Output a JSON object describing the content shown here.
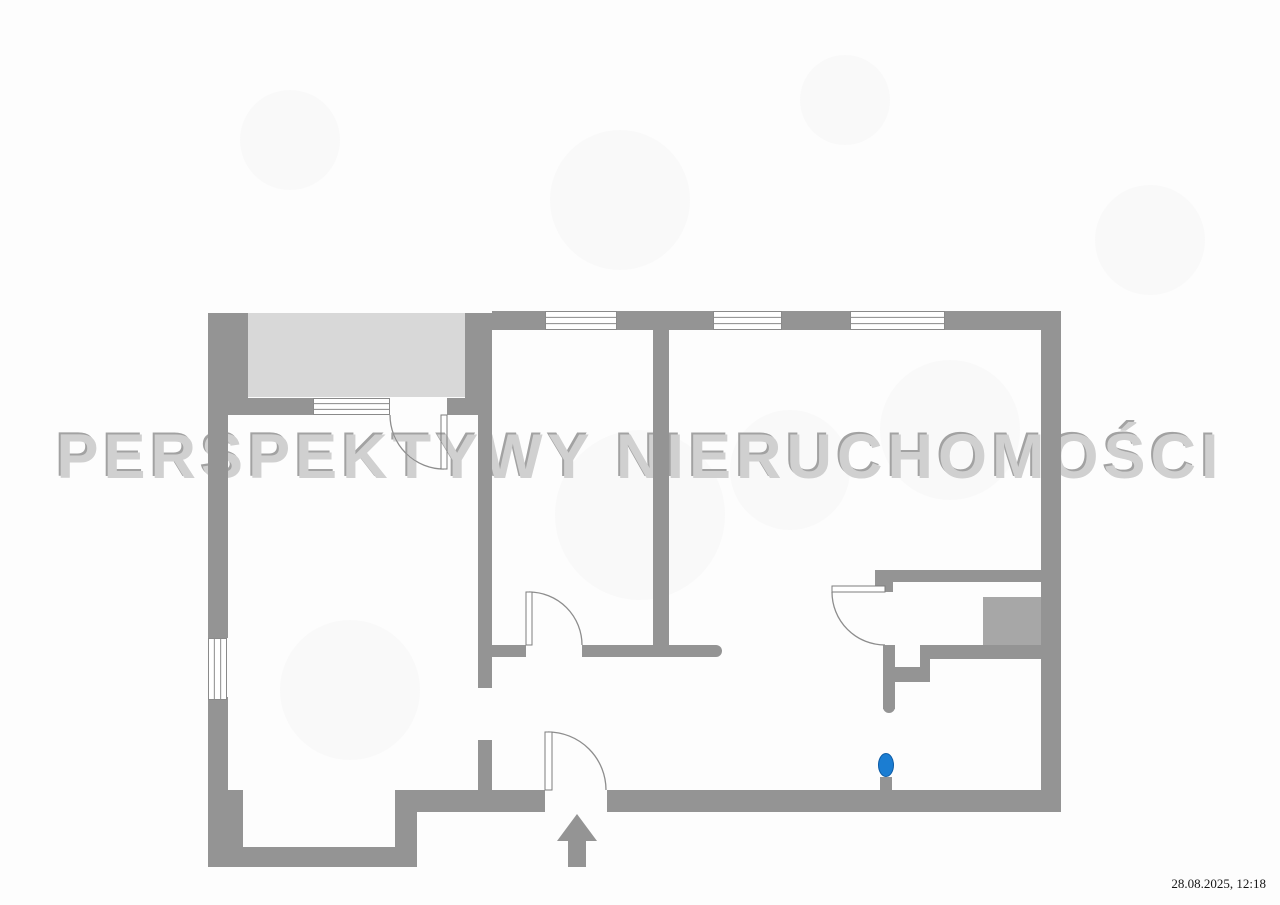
{
  "watermark": {
    "text": "PERSPEKTYWY NIERUCHOMOŚCI"
  },
  "footer": {
    "timestamp": "28.08.2025, 12:18"
  },
  "colors": {
    "background": "#fdfdfd",
    "wall": "#949494",
    "balcony_fill": "#d8d8d8",
    "shaft_fill": "#a7a7a7",
    "window_frame": "#8a8a8a",
    "door_line": "#8d8d8d",
    "door_leaf_stroke": "#7d7d7d",
    "pin_blue": "#1b7dd2",
    "pin_blue_dark": "#0d5ca6",
    "watermark_gray": "#d0d0d0"
  },
  "floorplan": {
    "canvas": {
      "width": 1280,
      "height": 905
    },
    "fills": [
      {
        "name": "balcony-area",
        "x": 248,
        "y": 313,
        "w": 217,
        "h": 84,
        "color_key": "balcony_fill"
      },
      {
        "name": "shaft-area",
        "x": 983,
        "y": 597,
        "w": 58,
        "h": 51,
        "color_key": "shaft_fill"
      }
    ],
    "walls": [
      {
        "x": 492,
        "y": 311,
        "w": 53,
        "h": 19
      },
      {
        "x": 617,
        "y": 311,
        "w": 96,
        "h": 19
      },
      {
        "x": 782,
        "y": 311,
        "w": 68,
        "h": 19
      },
      {
        "x": 945,
        "y": 311,
        "w": 116,
        "h": 19
      },
      {
        "x": 1041,
        "y": 311,
        "w": 20,
        "h": 501
      },
      {
        "x": 607,
        "y": 790,
        "w": 434,
        "h": 22
      },
      {
        "x": 417,
        "y": 790,
        "w": 128,
        "h": 22
      },
      {
        "x": 395,
        "y": 790,
        "w": 22,
        "h": 77
      },
      {
        "x": 208,
        "y": 847,
        "w": 209,
        "h": 20
      },
      {
        "x": 208,
        "y": 790,
        "w": 35,
        "h": 57
      },
      {
        "x": 208,
        "y": 313,
        "w": 40,
        "h": 85
      },
      {
        "x": 208,
        "y": 398,
        "w": 20,
        "h": 240
      },
      {
        "x": 208,
        "y": 697,
        "w": 20,
        "h": 150
      },
      {
        "x": 465,
        "y": 313,
        "w": 27,
        "h": 102
      },
      {
        "x": 228,
        "y": 398,
        "w": 85,
        "h": 17
      },
      {
        "x": 447,
        "y": 398,
        "w": 18,
        "h": 17
      },
      {
        "x": 478,
        "y": 415,
        "w": 14,
        "h": 273
      },
      {
        "x": 478,
        "y": 740,
        "w": 14,
        "h": 50
      },
      {
        "x": 478,
        "y": 645,
        "w": 48,
        "h": 12
      },
      {
        "x": 582,
        "y": 645,
        "w": 134,
        "h": 12
      },
      {
        "x": 653,
        "y": 330,
        "w": 16,
        "h": 321
      },
      {
        "x": 875,
        "y": 570,
        "w": 166,
        "h": 12
      },
      {
        "x": 875,
        "y": 570,
        "w": 18,
        "h": 22
      },
      {
        "x": 883,
        "y": 645,
        "w": 12,
        "h": 64
      },
      {
        "x": 930,
        "y": 645,
        "w": 111,
        "h": 14
      },
      {
        "x": 920,
        "y": 645,
        "w": 10,
        "h": 24
      },
      {
        "x": 891,
        "y": 667,
        "w": 39,
        "h": 15
      },
      {
        "x": 880,
        "y": 777,
        "w": 12,
        "h": 14
      }
    ],
    "wall_end_caps": [
      {
        "cx": 716,
        "cy": 651,
        "r": 6
      },
      {
        "cx": 889,
        "cy": 707,
        "r": 6
      }
    ],
    "windows": [
      {
        "x": 545,
        "y": 311,
        "w": 72,
        "h": 19,
        "dir": "h"
      },
      {
        "x": 713,
        "y": 311,
        "w": 69,
        "h": 19,
        "dir": "h"
      },
      {
        "x": 850,
        "y": 311,
        "w": 95,
        "h": 19,
        "dir": "h"
      },
      {
        "x": 208,
        "y": 638,
        "w": 19,
        "h": 62,
        "dir": "v"
      },
      {
        "x": 313,
        "y": 398,
        "w": 77,
        "h": 17,
        "dir": "h"
      }
    ],
    "doors": [
      {
        "name": "balcony-door",
        "leaf": {
          "x": 441,
          "y": 415,
          "w": 6,
          "h": 54
        },
        "arc": "M390,415 A54,54 0 0 0 444,469"
      },
      {
        "name": "room-door",
        "leaf": {
          "x": 526,
          "y": 592,
          "w": 6,
          "h": 53
        },
        "arc": "M529,592 A53,53 0 0 1 582,645"
      },
      {
        "name": "entrance-door",
        "leaf": {
          "x": 545,
          "y": 732,
          "w": 7,
          "h": 58
        },
        "arc": "M548,732 A58,58 0 0 1 606,790"
      },
      {
        "name": "kitchen-door",
        "leaf": {
          "x": 832,
          "y": 586,
          "w": 53,
          "h": 6
        },
        "arc": "M832,592 A53,53 0 0 0 885,645"
      }
    ],
    "entrance_arrow": {
      "points": "577,814 597,841 586,841 586,867 568,867 568,841 557,841"
    },
    "location_pin": {
      "cx": 886,
      "cy": 765,
      "rx": 7.5,
      "ry": 11.5
    },
    "scan_smudges": [
      {
        "cx": 620,
        "cy": 200,
        "r": 70
      },
      {
        "cx": 845,
        "cy": 100,
        "r": 45
      },
      {
        "cx": 1150,
        "cy": 240,
        "r": 55
      },
      {
        "cx": 290,
        "cy": 140,
        "r": 50
      },
      {
        "cx": 640,
        "cy": 515,
        "r": 85
      },
      {
        "cx": 790,
        "cy": 470,
        "r": 60
      },
      {
        "cx": 350,
        "cy": 690,
        "r": 70
      },
      {
        "cx": 950,
        "cy": 430,
        "r": 70
      }
    ]
  }
}
